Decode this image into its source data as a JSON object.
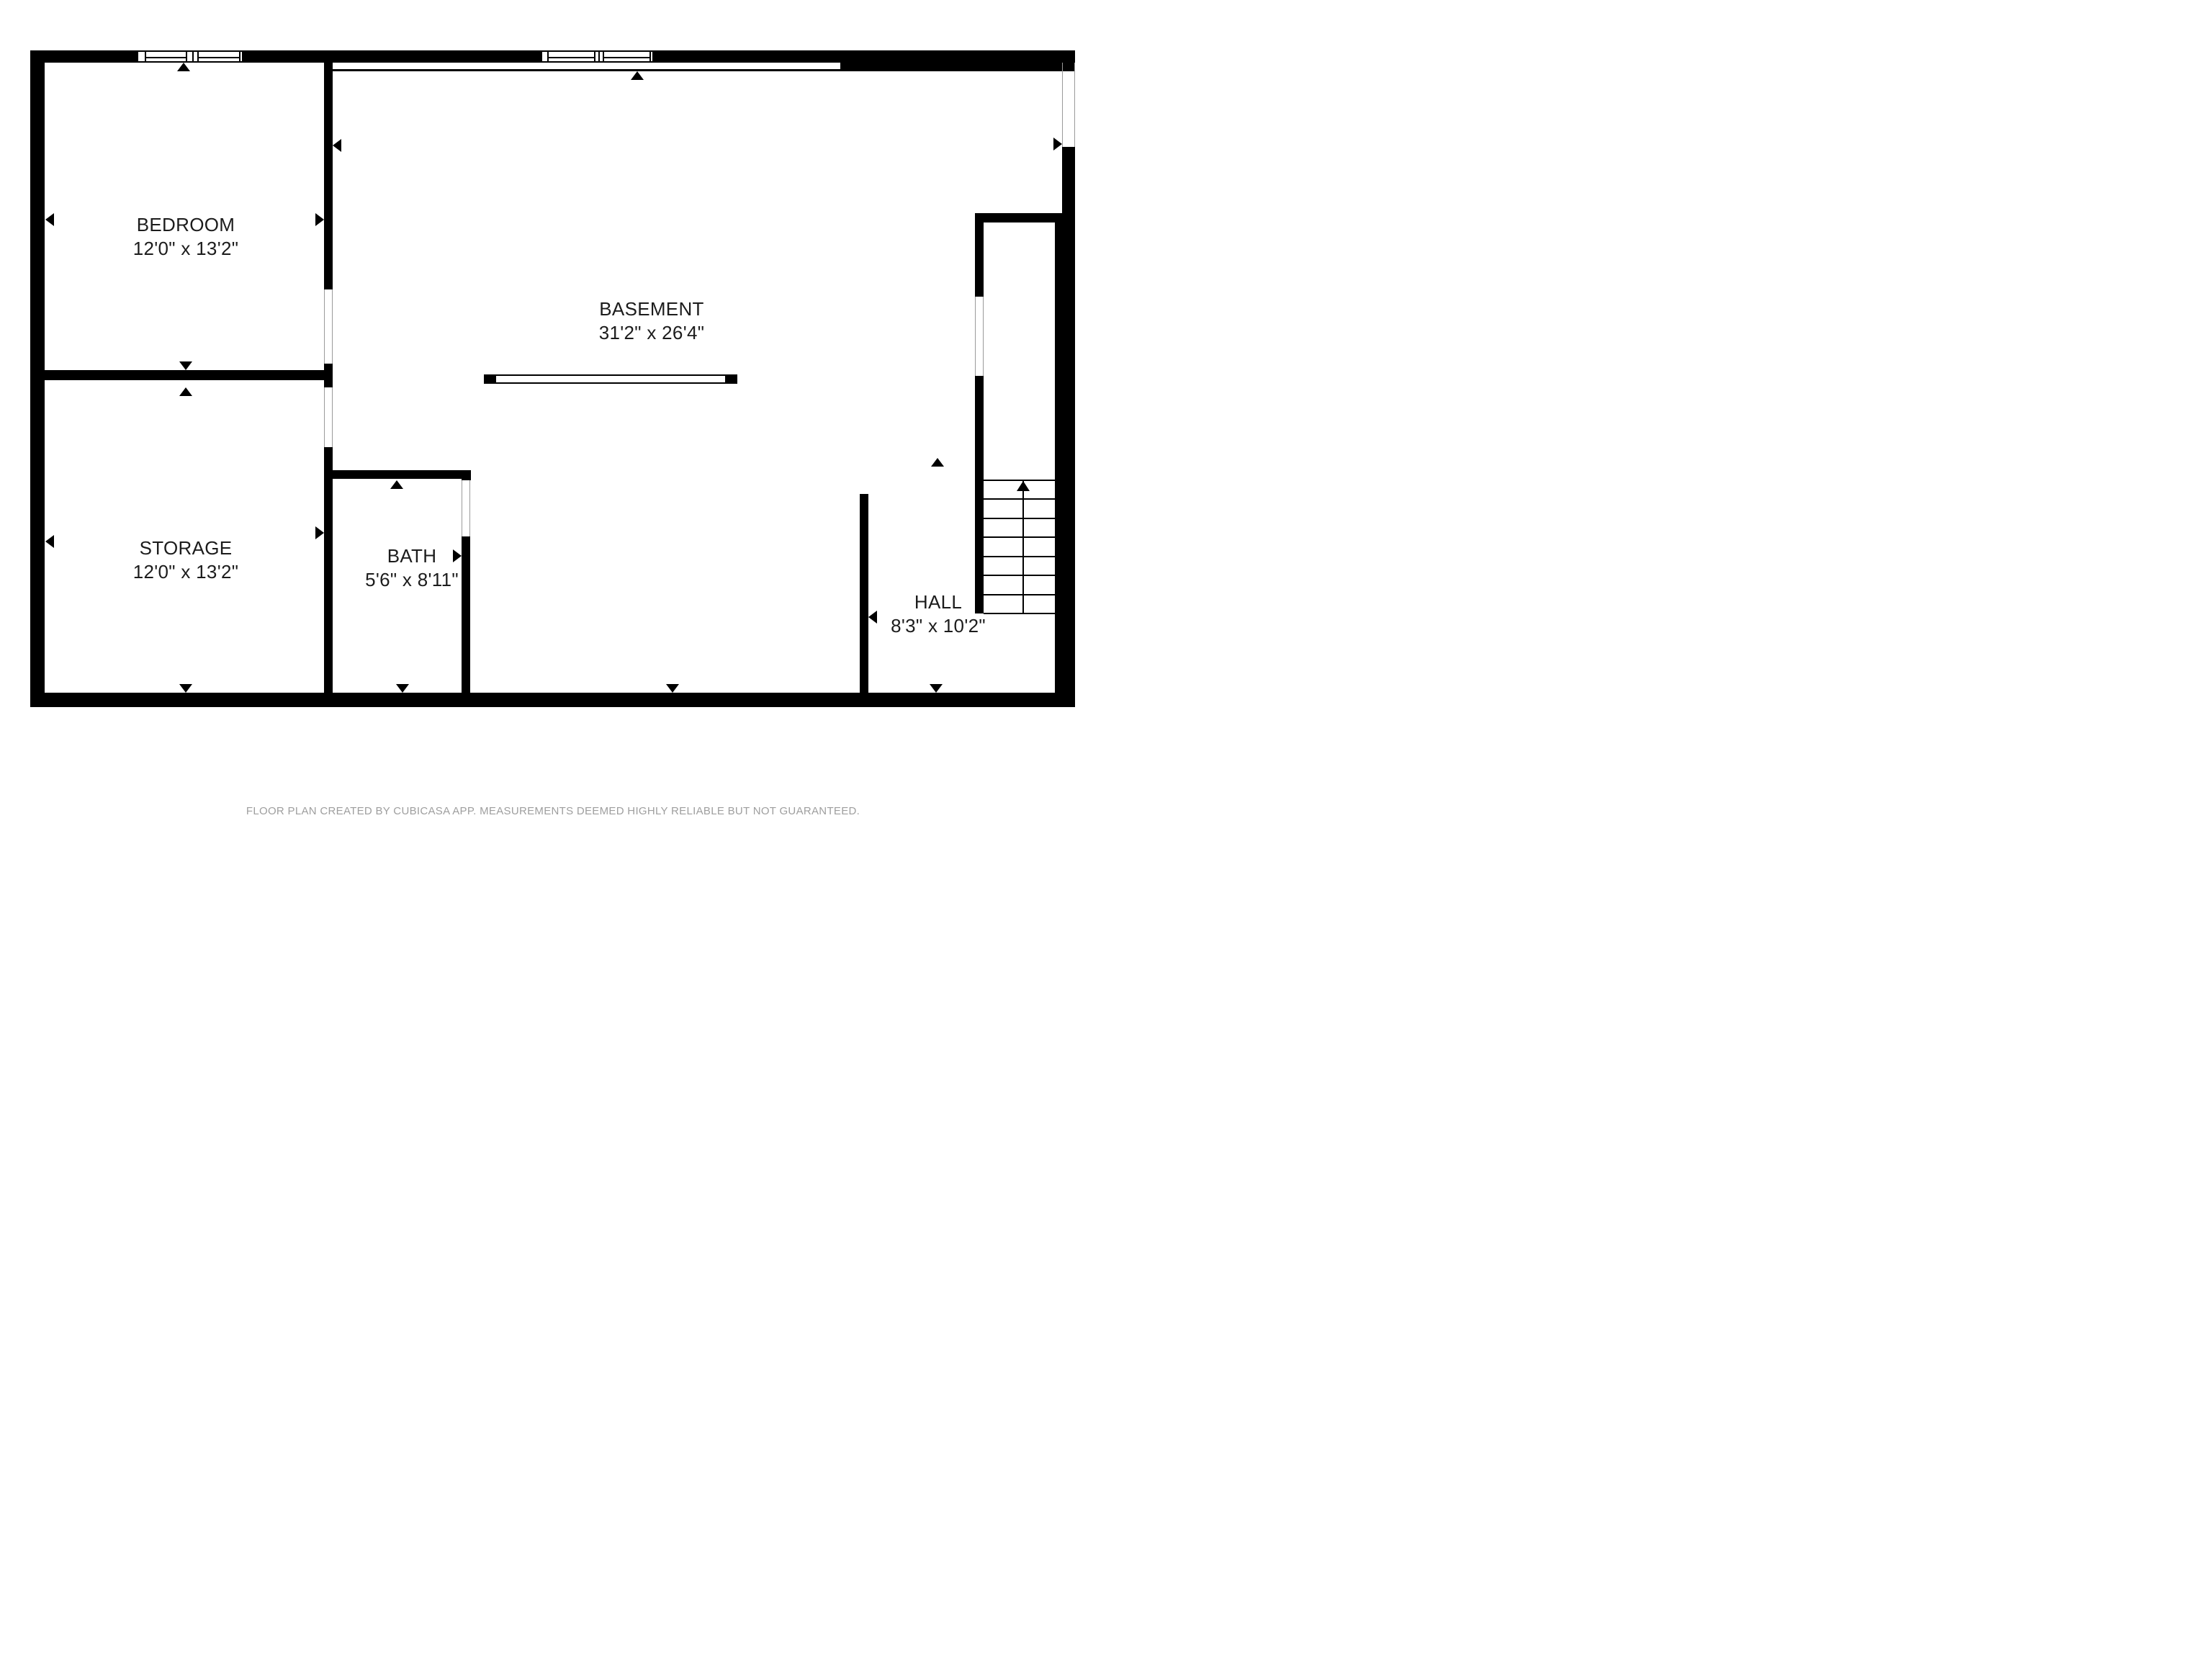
{
  "plan": {
    "type": "floor-plan",
    "floor_name": "Basement level"
  },
  "rooms": [
    {
      "name": "BEDROOM",
      "dims": "12'0\" x 13'2\""
    },
    {
      "name": "BASEMENT",
      "dims": "31'2\" x 26'4\""
    },
    {
      "name": "STORAGE",
      "dims": "12'0\" x 13'2\""
    },
    {
      "name": "BATH",
      "dims": "5'6\" x 8'11\""
    },
    {
      "name": "HALL",
      "dims": "8'3\" x 10'2\""
    }
  ],
  "stairs": {
    "direction": "up",
    "tread_rows": 7
  },
  "footer": {
    "text": "FLOOR PLAN CREATED BY CUBICASA APP. MEASUREMENTS DEEMED HIGHLY RELIABLE BUT NOT GUARANTEED."
  },
  "colors": {
    "wall": "#000000",
    "background": "#ffffff",
    "label_text": "#1c1c1c",
    "footer_text": "#9e9e9e"
  }
}
